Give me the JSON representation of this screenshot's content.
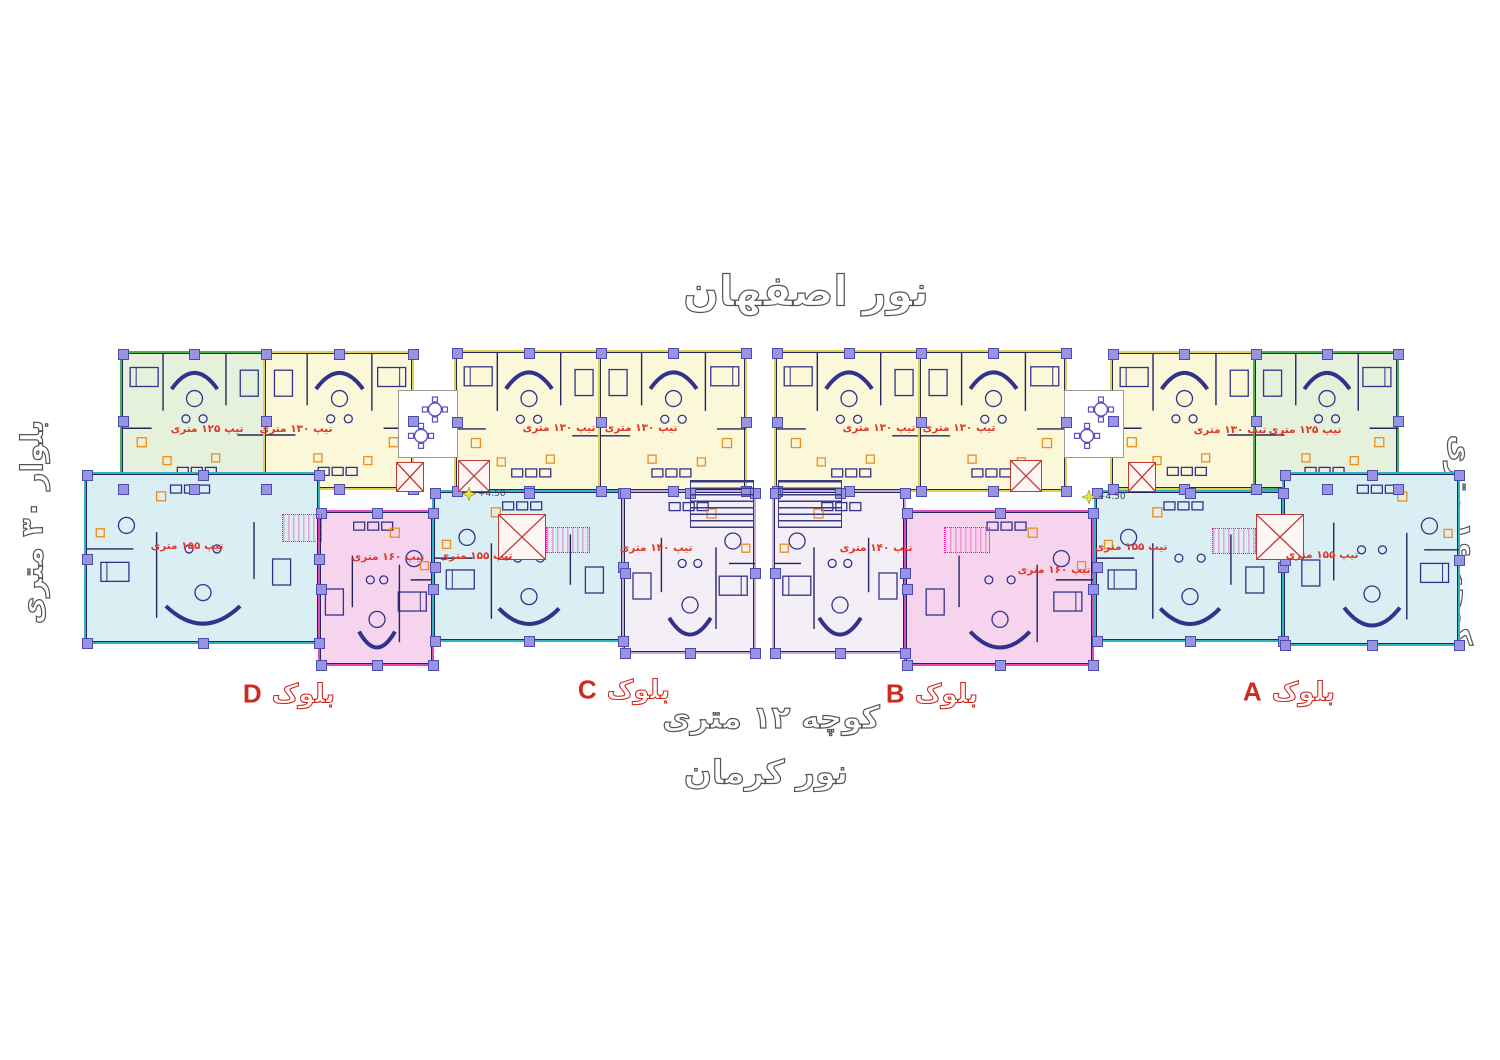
{
  "streets": {
    "top": "نور اصفهان",
    "bottom": "نور کرمان",
    "bottom_alley": "کوچه ۱۲ متری",
    "left": "بلوار ۳۰ متری",
    "right": "کوچه ۱۶ متری"
  },
  "blocks": {
    "a": {
      "word": "بلوک",
      "letter": "A"
    },
    "b": {
      "word": "بلوک",
      "letter": "B"
    },
    "c": {
      "word": "بلوک",
      "letter": "C"
    },
    "d": {
      "word": "بلوک",
      "letter": "D"
    }
  },
  "plan": {
    "palettes": {
      "green": {
        "fill": "#e6f1dc",
        "stroke": "#49b14e"
      },
      "yellow": {
        "fill": "#fbf8da",
        "stroke": "#ddd34f"
      },
      "cyan": {
        "fill": "#d9eff3",
        "stroke": "#2fb4c4"
      },
      "pink": {
        "fill": "#f6d4ee",
        "stroke": "#e049c0"
      },
      "lavender": {
        "fill": "#f4eef6",
        "stroke": "#c3abd6"
      }
    },
    "ink": {
      "walls": "#26265e",
      "furniture": "#32328c",
      "column_fill": "#9a93e3",
      "column_stroke": "#4c4cae",
      "orange": "#ef8c1a",
      "type_label": "#e0372b",
      "elevator": "#bf3a30",
      "stair_magenta": "#ee14a4",
      "tread": "#3a3a85",
      "marker_yellow": "#e8e23a",
      "terrace_table": "#5b4fc0"
    },
    "units": [
      {
        "id": "t1a",
        "block": "D",
        "row": "top",
        "x": 122,
        "y": 353,
        "w": 143,
        "h": 135,
        "palette": "green",
        "label": "تیپ ۱۲۵ متری",
        "lx": 207,
        "ly": 429,
        "mirror": false
      },
      {
        "id": "t1b",
        "block": "D",
        "row": "top",
        "x": 265,
        "y": 353,
        "w": 147,
        "h": 135,
        "palette": "yellow",
        "label": "تیپ ۱۳۰ متری",
        "lx": 296,
        "ly": 429,
        "mirror": true
      },
      {
        "id": "t2a",
        "block": "C",
        "row": "top",
        "x": 456,
        "y": 352,
        "w": 144,
        "h": 138,
        "palette": "yellow",
        "label": "تیپ ۱۳۰ متری",
        "lx": 559,
        "ly": 428,
        "mirror": false
      },
      {
        "id": "t2b",
        "block": "C",
        "row": "top",
        "x": 600,
        "y": 352,
        "w": 145,
        "h": 138,
        "palette": "yellow",
        "label": "تیپ ۱۳۰ متری",
        "lx": 641,
        "ly": 428,
        "mirror": true
      },
      {
        "id": "t3a",
        "block": "B",
        "row": "top",
        "x": 776,
        "y": 352,
        "w": 144,
        "h": 138,
        "palette": "yellow",
        "label": "تیپ ۱۳۰ متری",
        "lx": 879,
        "ly": 428,
        "mirror": false
      },
      {
        "id": "t3b",
        "block": "B",
        "row": "top",
        "x": 920,
        "y": 352,
        "w": 145,
        "h": 138,
        "palette": "yellow",
        "label": "تیپ ۱۳۰ متری",
        "lx": 959,
        "ly": 428,
        "mirror": true
      },
      {
        "id": "t4a",
        "block": "A",
        "row": "top",
        "x": 1112,
        "y": 353,
        "w": 143,
        "h": 135,
        "palette": "yellow",
        "label": "تیپ ۱۳۰ متری",
        "lx": 1230,
        "ly": 430,
        "mirror": false
      },
      {
        "id": "t4b",
        "block": "A",
        "row": "top",
        "x": 1255,
        "y": 353,
        "w": 142,
        "h": 135,
        "palette": "green",
        "label": "تیپ ۱۲۵ متری",
        "lx": 1305,
        "ly": 430,
        "mirror": true
      },
      {
        "id": "d1",
        "block": "D",
        "row": "bottom",
        "x": 86,
        "y": 474,
        "w": 232,
        "h": 168,
        "palette": "cyan",
        "label": "تیپ ۱۵۵ متری",
        "lx": 187,
        "ly": 546,
        "mirror": false
      },
      {
        "id": "d2",
        "block": "D",
        "row": "bottom",
        "x": 320,
        "y": 512,
        "w": 112,
        "h": 152,
        "palette": "pink",
        "label": "تیپ ۱۶۰ متری",
        "lx": 388,
        "ly": 557,
        "mirror": true
      },
      {
        "id": "c1",
        "block": "C",
        "row": "bottom",
        "x": 434,
        "y": 492,
        "w": 188,
        "h": 148,
        "palette": "cyan",
        "label": "تیپ ۱۵۵ متری",
        "lx": 476,
        "ly": 556,
        "mirror": false
      },
      {
        "id": "c2",
        "block": "C",
        "row": "bottom",
        "x": 624,
        "y": 492,
        "w": 130,
        "h": 160,
        "palette": "lavender",
        "label": "تیپ ۱۴۰ متری",
        "lx": 656,
        "ly": 548,
        "mirror": true
      },
      {
        "id": "b1",
        "block": "B",
        "row": "bottom",
        "x": 774,
        "y": 492,
        "w": 130,
        "h": 160,
        "palette": "lavender",
        "label": "تیپ ۱۴۰ متری",
        "lx": 876,
        "ly": 548,
        "mirror": false
      },
      {
        "id": "b2",
        "block": "B",
        "row": "bottom",
        "x": 906,
        "y": 512,
        "w": 186,
        "h": 152,
        "palette": "pink",
        "label": "تیپ ۱۶۰ متری",
        "lx": 1054,
        "ly": 570,
        "mirror": true
      },
      {
        "id": "a1",
        "block": "A",
        "row": "bottom",
        "x": 1096,
        "y": 492,
        "w": 186,
        "h": 148,
        "palette": "cyan",
        "label": "تیپ ۱۵۵ متری",
        "lx": 1131,
        "ly": 547,
        "mirror": false
      },
      {
        "id": "a2",
        "block": "A",
        "row": "bottom",
        "x": 1284,
        "y": 474,
        "w": 174,
        "h": 170,
        "palette": "cyan",
        "label": "تیپ ۱۵۵ متری",
        "lx": 1322,
        "ly": 555,
        "mirror": true
      }
    ],
    "elevators": [
      {
        "x": 396,
        "y": 462,
        "w": 26,
        "h": 28
      },
      {
        "x": 458,
        "y": 460,
        "w": 30,
        "h": 30
      },
      {
        "x": 1010,
        "y": 460,
        "w": 30,
        "h": 30
      },
      {
        "x": 1128,
        "y": 462,
        "w": 26,
        "h": 28
      },
      {
        "x": 498,
        "y": 514,
        "w": 46,
        "h": 44
      },
      {
        "x": 1256,
        "y": 514,
        "w": 46,
        "h": 44
      }
    ],
    "stairs_magenta": [
      {
        "x": 282,
        "y": 514,
        "w": 38,
        "h": 26
      },
      {
        "x": 546,
        "y": 527,
        "w": 42,
        "h": 24
      },
      {
        "x": 944,
        "y": 527,
        "w": 44,
        "h": 24
      },
      {
        "x": 1212,
        "y": 528,
        "w": 42,
        "h": 24
      }
    ],
    "stair_treads": [
      {
        "x": 690,
        "y": 480,
        "w": 62,
        "h": 46
      },
      {
        "x": 778,
        "y": 480,
        "w": 62,
        "h": 46
      }
    ],
    "terraces": [
      {
        "x": 398,
        "y": 390,
        "w": 58,
        "h": 66
      },
      {
        "x": 1064,
        "y": 390,
        "w": 58,
        "h": 66
      }
    ],
    "elevation_markers": [
      {
        "x": 462,
        "y": 494,
        "text": "+4.50"
      },
      {
        "x": 1082,
        "y": 497,
        "text": "+4.50"
      }
    ]
  }
}
